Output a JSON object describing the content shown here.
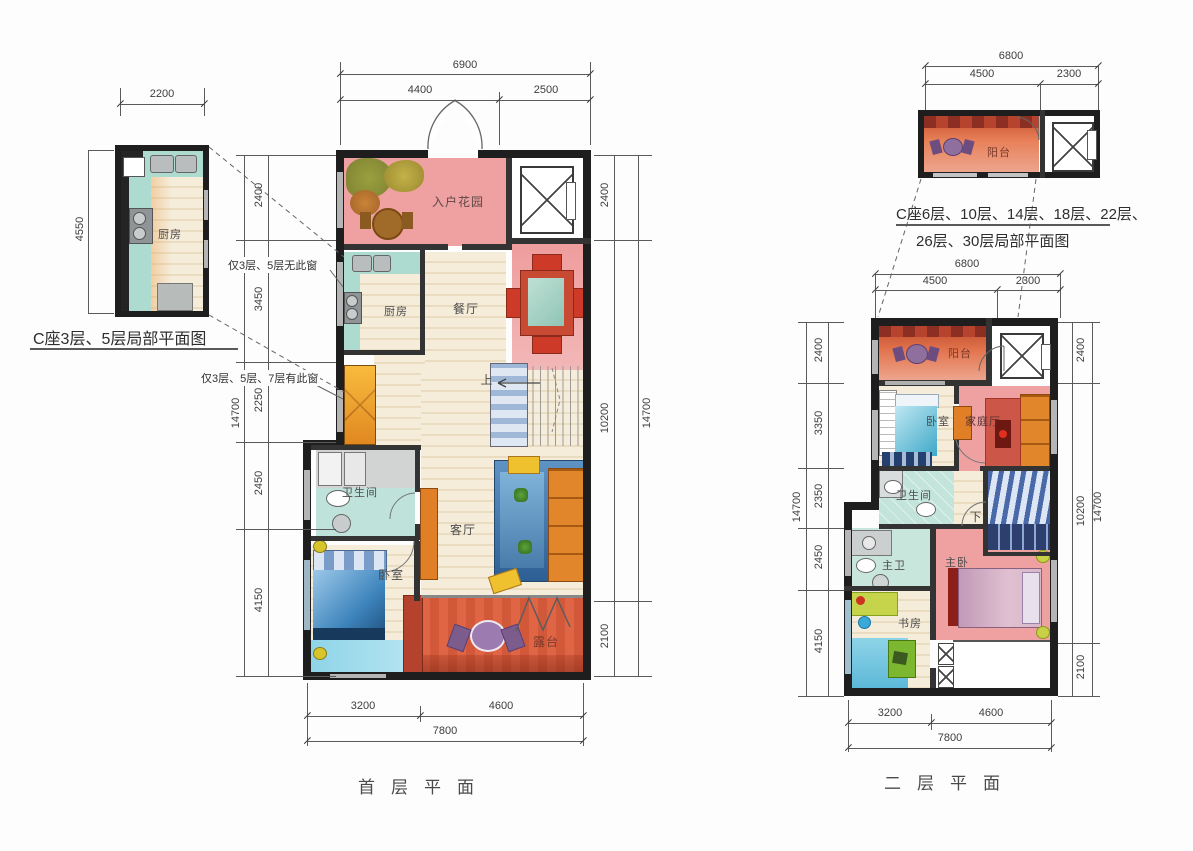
{
  "colors": {
    "wall": "#1e1e1e",
    "pink_room": "#efa0a0",
    "light_pink": "#f2b7b7",
    "terrace_orange": "#d95c38",
    "teal": "#aedbd0",
    "bath_teal": "#c2e4da",
    "floor_cream": "#f5ecda",
    "bed_blue": "#3e85bd",
    "cyan_floor": "#8fd4e8",
    "sofa_orange": "#e2862c",
    "dim_text": "#3d3d3d"
  },
  "detail_left": {
    "caption": "C座3层、5层局部平面图",
    "room_kitchen": "厨房",
    "dim_top": "2200",
    "dim_left": "4550"
  },
  "first_floor": {
    "title": "首层平面",
    "rooms": {
      "entry_garden": "入户花园",
      "kitchen": "厨房",
      "dining": "餐厅",
      "living": "客厅",
      "bathroom": "卫生间",
      "bedroom": "卧室",
      "terrace": "露台",
      "stairs_up": "上"
    },
    "notes": {
      "window_none": "仅3层、5层无此窗",
      "window_some": "仅3层、5层、7层有此窗"
    },
    "dims": {
      "top": {
        "total": "6900",
        "segs": [
          "4400",
          "2500"
        ]
      },
      "left": {
        "total": "14700",
        "segs": [
          "2400",
          "3450",
          "2250",
          "2450",
          "4150"
        ]
      },
      "right": {
        "total": "14700",
        "segs": [
          "2400",
          "10200",
          "2100"
        ]
      },
      "bottom": {
        "total": "7800",
        "segs": [
          "3200",
          "4600"
        ]
      }
    }
  },
  "detail_right": {
    "caption_line1": "C座6层、10层、14层、18层、22层、",
    "caption_line2": "26层、30层局部平面图",
    "room_balcony": "阳台",
    "dims": {
      "total": "6800",
      "segs": [
        "4500",
        "2300"
      ]
    }
  },
  "second_floor": {
    "title": "二层平面",
    "rooms": {
      "balcony": "阳台",
      "bedroom": "卧室",
      "family": "家庭厅",
      "bathroom": "卫生间",
      "stairs_down": "下",
      "master_bath": "主卫",
      "master_bedroom": "主卧",
      "study": "书房"
    },
    "dims": {
      "top": {
        "total": "6800",
        "segs": [
          "4500",
          "2300"
        ]
      },
      "left": {
        "total": "14700",
        "segs": [
          "2400",
          "3350",
          "2350",
          "2450",
          "4150"
        ]
      },
      "right": {
        "total": "14700",
        "segs": [
          "2400",
          "10200",
          "2100"
        ]
      },
      "bottom": {
        "total": "7800",
        "segs": [
          "3200",
          "4600"
        ]
      }
    }
  }
}
